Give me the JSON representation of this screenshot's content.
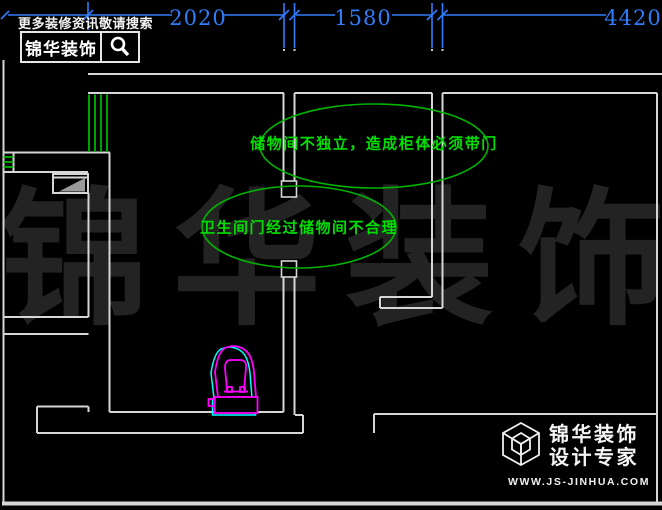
{
  "colors": {
    "bg": "#000000",
    "wall": "#d6d6d6",
    "dim": "#2f7dfa",
    "green": "#00b400",
    "green-text": "#00df00",
    "magenta": "#ff00ff",
    "cyan": "#00ffff",
    "watermark": "#232323",
    "white": "#f2f2f2"
  },
  "dimensions": {
    "values": [
      "2020",
      "1580",
      "4420"
    ]
  },
  "ad_badge": {
    "slogan": "更多装修资讯敬请搜索",
    "brand": "锦华装饰",
    "icon": "search-icon"
  },
  "annotations": {
    "storage": "储物间不独立，造成柜体必须带门",
    "bathroom": "卫生间门经过储物间不合理"
  },
  "watermark": {
    "chars": [
      "锦",
      "华",
      "装",
      "饰"
    ]
  },
  "plan": {
    "fixtures": [
      "toilet"
    ],
    "window_color": "#00b400"
  },
  "brand_footer": {
    "icon": "cube-logo-icon",
    "name": "锦华装饰",
    "tagline": "设计专家",
    "url": "WWW.JS-JINHUA.COM"
  }
}
